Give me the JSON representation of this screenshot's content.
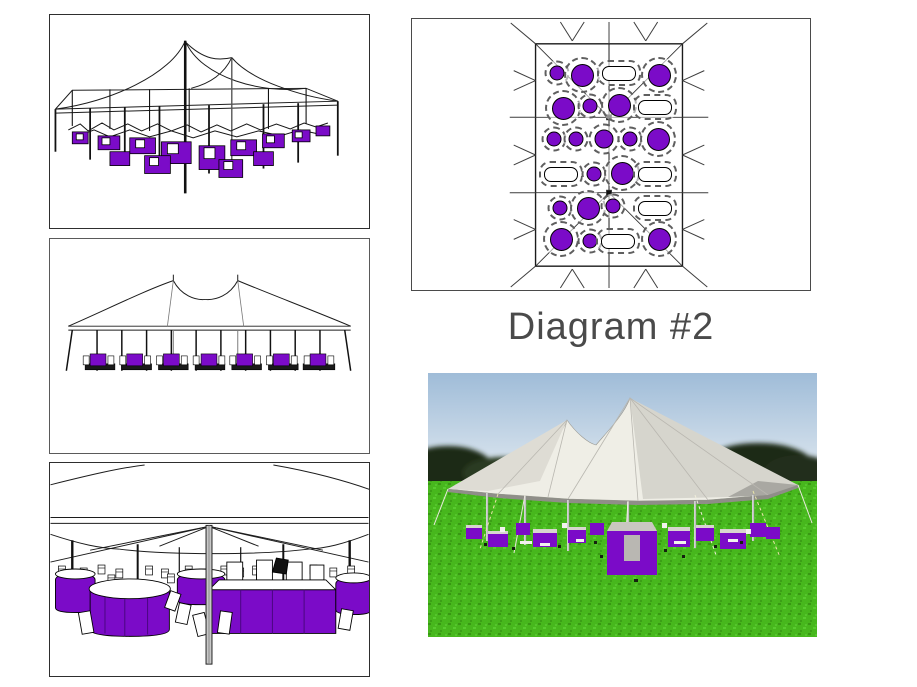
{
  "caption": {
    "label": "Diagram #2"
  },
  "colors": {
    "table_purple": "#7B0BC8",
    "line_dark": "#1C1C1C",
    "grass_green": "#47B71D",
    "grass_dark": "#368F12",
    "grass_light": "#5ECF35",
    "sky_top": "#9FBCD8",
    "sky_bottom": "#E8EEF3",
    "tree_dark": "#1F2917",
    "tent_light": "#EFEEE6",
    "tent_mid": "#D6D5CD",
    "tent_dark": "#A9A8A2"
  },
  "floor_plan": {
    "round_table_count": 19,
    "oval_table_count": 6,
    "tables": [
      {
        "type": "round-sm",
        "x": 145,
        "y": 54
      },
      {
        "type": "round-lg",
        "x": 170,
        "y": 56
      },
      {
        "type": "oval",
        "x": 207,
        "y": 54
      },
      {
        "type": "round-lg",
        "x": 247,
        "y": 56
      },
      {
        "type": "round-lg",
        "x": 151,
        "y": 89
      },
      {
        "type": "round-sm",
        "x": 178,
        "y": 87
      },
      {
        "type": "round-lg",
        "x": 207,
        "y": 86
      },
      {
        "type": "oval",
        "x": 243,
        "y": 88
      },
      {
        "type": "round-sm",
        "x": 142,
        "y": 120
      },
      {
        "type": "round-sm",
        "x": 164,
        "y": 120
      },
      {
        "type": "round-md",
        "x": 192,
        "y": 120
      },
      {
        "type": "round-sm",
        "x": 218,
        "y": 120
      },
      {
        "type": "round-lg",
        "x": 246,
        "y": 120
      },
      {
        "type": "oval",
        "x": 149,
        "y": 155
      },
      {
        "type": "round-sm",
        "x": 182,
        "y": 155
      },
      {
        "type": "round-lg",
        "x": 210,
        "y": 154
      },
      {
        "type": "oval",
        "x": 243,
        "y": 155
      },
      {
        "type": "round-sm",
        "x": 148,
        "y": 189
      },
      {
        "type": "round-lg",
        "x": 176,
        "y": 189
      },
      {
        "type": "round-sm",
        "x": 201,
        "y": 187
      },
      {
        "type": "oval",
        "x": 243,
        "y": 189
      },
      {
        "type": "round-lg",
        "x": 149,
        "y": 220
      },
      {
        "type": "round-sm",
        "x": 178,
        "y": 222
      },
      {
        "type": "oval",
        "x": 206,
        "y": 222
      },
      {
        "type": "round-lg",
        "x": 247,
        "y": 220
      }
    ]
  }
}
